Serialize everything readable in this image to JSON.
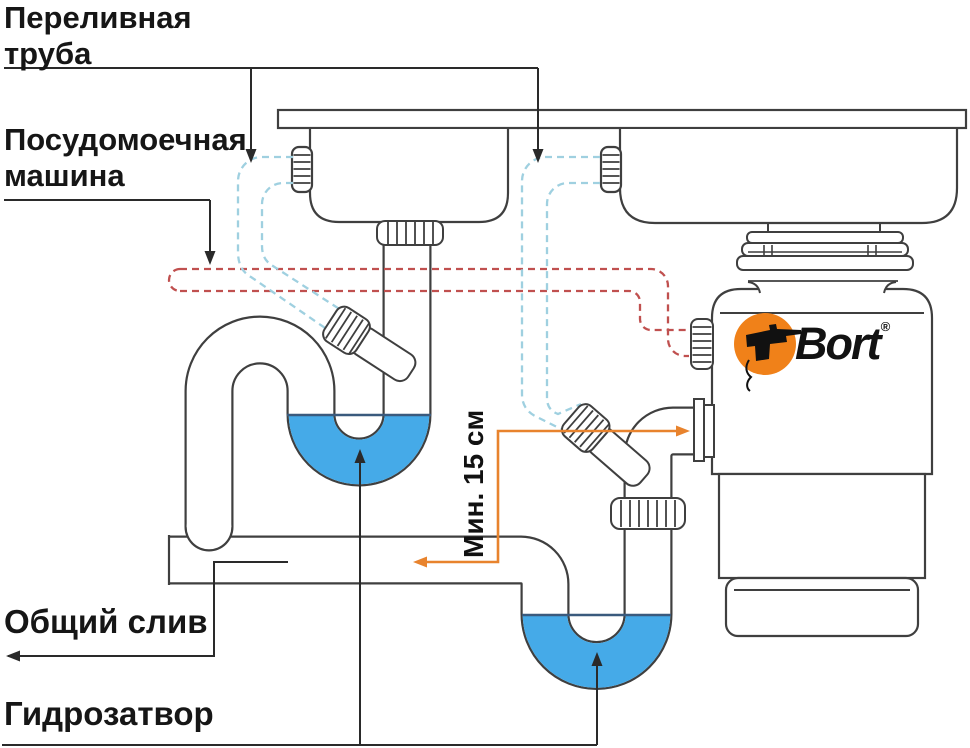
{
  "labels": {
    "overflow_pipe": "Переливная\nтруба",
    "dishwasher": "Посудомоечная\nмашина",
    "common_drain": "Общий слив",
    "water_trap": "Гидрозатвор",
    "min_distance": "Мин. 15 см"
  },
  "brand": {
    "name": "Bort",
    "registered_mark": "®"
  },
  "colors": {
    "outline_dark": "#3f3f3f",
    "callout_black": "#2a2a2a",
    "water_fill": "#45aae8",
    "waterline": "#3a5a7d",
    "overflow_hose_dash_blue": "#9fd0e0",
    "dishwasher_hose_dash_red": "#c0504f",
    "dimension_orange": "#e8832d",
    "brand_orange": "#f08119",
    "background": "#ffffff"
  }
}
